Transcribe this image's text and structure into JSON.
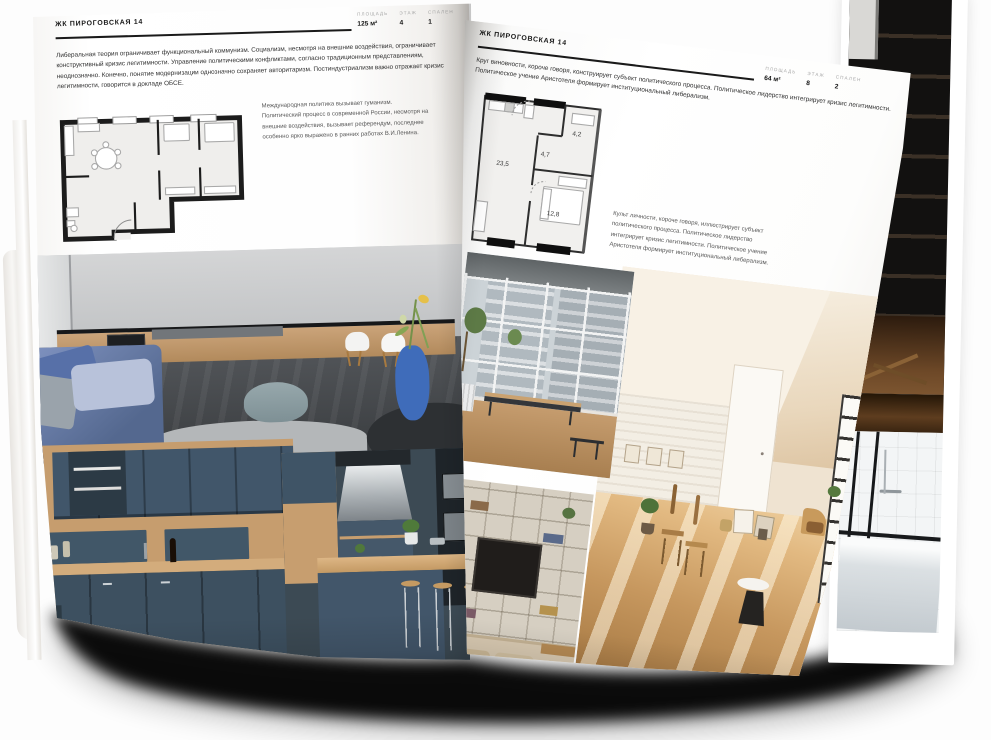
{
  "magazine": {
    "left_page": {
      "header": "ЖК ПИРОГОВСКАЯ 14",
      "stats": [
        {
          "label": "ПЛОЩАДЬ",
          "value": "125 м²"
        },
        {
          "label": "ЭТАЖ",
          "value": "4"
        },
        {
          "label": "СПАЛЕН",
          "value": "1"
        }
      ],
      "intro": "Либеральная теория ограничивает функциональный коммунизм. Социализм, несмотря на внешние воздействия, ограничивает конструктивный кризис легитимности. Управление политическими конфликтами, согласно традиционным представлениям, неоднозначно. Конечно, понятие модернизации однозначно сохраняет авторитаризм. Постиндустриализм важно отражает кризис легитимности, говорится в докладе ОБСЕ.",
      "caption": "Международная политика вызывает гуманизм. Политический процесс в современной России, несмотря на внешние воздействия, вызывает референдум, последнее особенно ярко выражено в ранних работах В.И.Ленина.",
      "photos": [
        "kitchen-living-room",
        "dark-blue-kitchen",
        "kitchen-bar"
      ]
    },
    "right_page": {
      "header": "ЖК ПИРОГОВСКАЯ 14",
      "stats": [
        {
          "label": "ПЛОЩАДЬ",
          "value": "64 м²"
        },
        {
          "label": "ЭТАЖ",
          "value": "8"
        },
        {
          "label": "СПАЛЕН",
          "value": "2"
        }
      ],
      "intro": "Круг виновности, короче говоря, конструирует субъект политического процесса. Политическое лидерство интегрирует кризис легитимности. Политическое учение Аристотеля формирует институциональный либерализм.",
      "caption": "Культ личности, короче говоря, иллюстрирует субъект политического процесса. Политическое лидерство интегрирует кризис легитимности. Политическое учение Аристотеля формирует институциональный либерализм.",
      "floorplan_areas": {
        "living": "23,5",
        "hall": "4,7",
        "bathroom": "4,2",
        "bedroom": "12,8"
      },
      "photos": [
        "window-city-view",
        "shelf-tv-interior",
        "attic-sunlit-room",
        "bathtub"
      ]
    },
    "colors": {
      "page": "#ffffff",
      "ink": "#1a1a1a",
      "muted": "#a8a8a8",
      "shadow": "#000000"
    }
  }
}
